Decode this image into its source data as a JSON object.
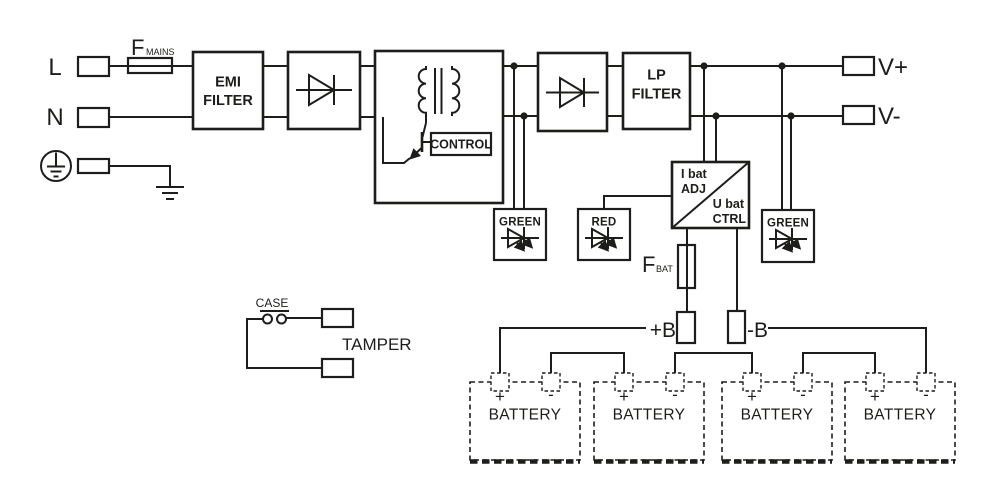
{
  "colors": {
    "ink": "#1d1d1b",
    "paper": "#ffffff"
  },
  "mains": {
    "line_label": "L",
    "neutral_label": "N",
    "fuse": {
      "symbol": "F",
      "subscript": "MAINS"
    }
  },
  "blocks": {
    "emi_filter": {
      "line1": "EMI",
      "line2": "FILTER"
    },
    "lp_filter": {
      "line1": "LP",
      "line2": "FILTER"
    },
    "control_label": "CONTROL",
    "bat_ctrl": {
      "top1": "I bat",
      "top2": "ADJ",
      "bottom1": "U bat",
      "bottom2": "CTRL"
    }
  },
  "outputs": {
    "v_plus": "V+",
    "v_minus": "V-"
  },
  "leds": {
    "converter_dc": "GREEN",
    "battery_fault": "RED",
    "output_dc": "GREEN"
  },
  "battery_circuit": {
    "fuse": {
      "symbol": "F",
      "subscript": "BAT"
    },
    "b_plus": "+B",
    "b_minus": "-B",
    "batteries": [
      {
        "plus": "+",
        "minus": "-",
        "label": "BATTERY"
      },
      {
        "plus": "+",
        "minus": "-",
        "label": "BATTERY"
      },
      {
        "plus": "+",
        "minus": "-",
        "label": "BATTERY"
      },
      {
        "plus": "+",
        "minus": "-",
        "label": "BATTERY"
      }
    ]
  },
  "tamper": {
    "switch_label": "CASE",
    "label": "TAMPER"
  }
}
